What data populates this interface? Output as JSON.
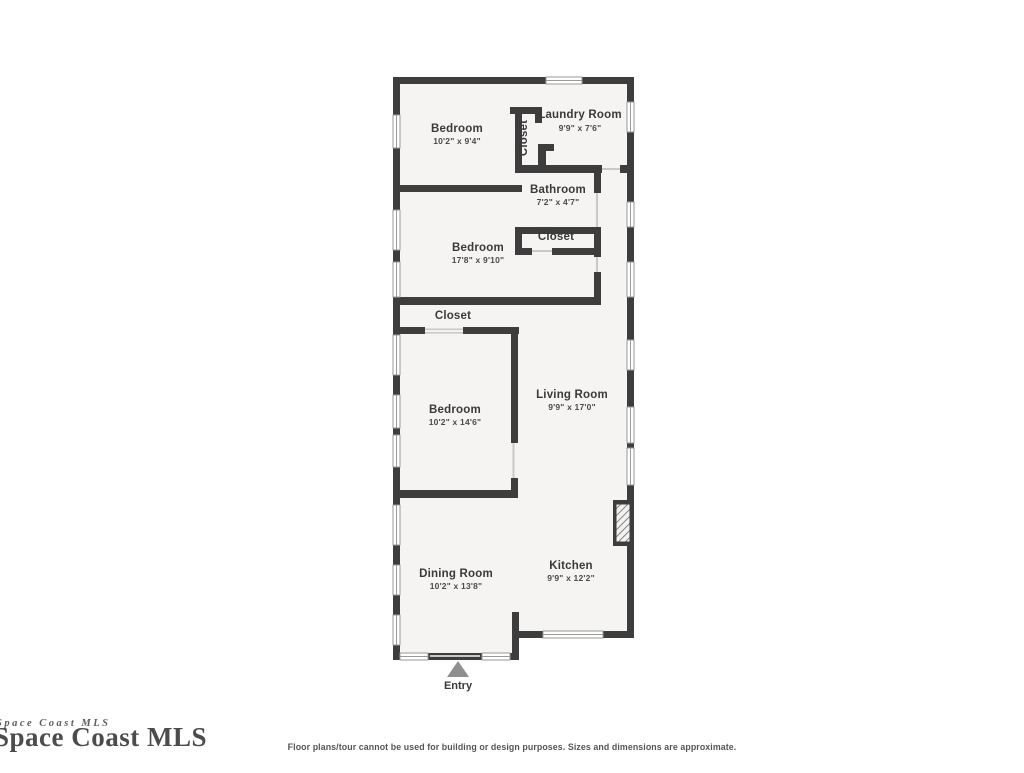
{
  "floorplan": {
    "rooms": {
      "bedroom1": {
        "label": "Bedroom",
        "dims": "10'2\" x 9'4\""
      },
      "laundry": {
        "label": "Laundry Room",
        "dims": "9'9\" x 7'6\""
      },
      "closet_laundry": {
        "label": "Closet"
      },
      "bathroom": {
        "label": "Bathroom",
        "dims": "7'2\" x 4'7\""
      },
      "closet_hall": {
        "label": "Closet"
      },
      "bedroom2": {
        "label": "Bedroom",
        "dims": "17'8\" x 9'10\""
      },
      "closet_bedroom3": {
        "label": "Closet"
      },
      "bedroom3": {
        "label": "Bedroom",
        "dims": "10'2\" x 14'6\""
      },
      "living": {
        "label": "Living Room",
        "dims": "9'9\" x 17'0\""
      },
      "dining": {
        "label": "Dining Room",
        "dims": "10'2\" x 13'8\""
      },
      "kitchen": {
        "label": "Kitchen",
        "dims": "9'9\" x 12'2\""
      },
      "entry": {
        "label": "Entry"
      }
    },
    "colors": {
      "wall": "#3d3d3d",
      "floor": "#f5f4f2",
      "label_text": "#3a3a3a",
      "dim_text": "#4a4a4a",
      "window_line": "#9a9a9a",
      "door_line": "#c9c9c9",
      "entry_arrow": "#8f8f8f"
    }
  },
  "watermark": {
    "text": "Space Coast MLS",
    "overlay_text": "Space Coast MLS"
  },
  "footer": {
    "disclaimer": "Floor plans/tour cannot be used for building or design purposes. Sizes and dimensions are approximate."
  }
}
